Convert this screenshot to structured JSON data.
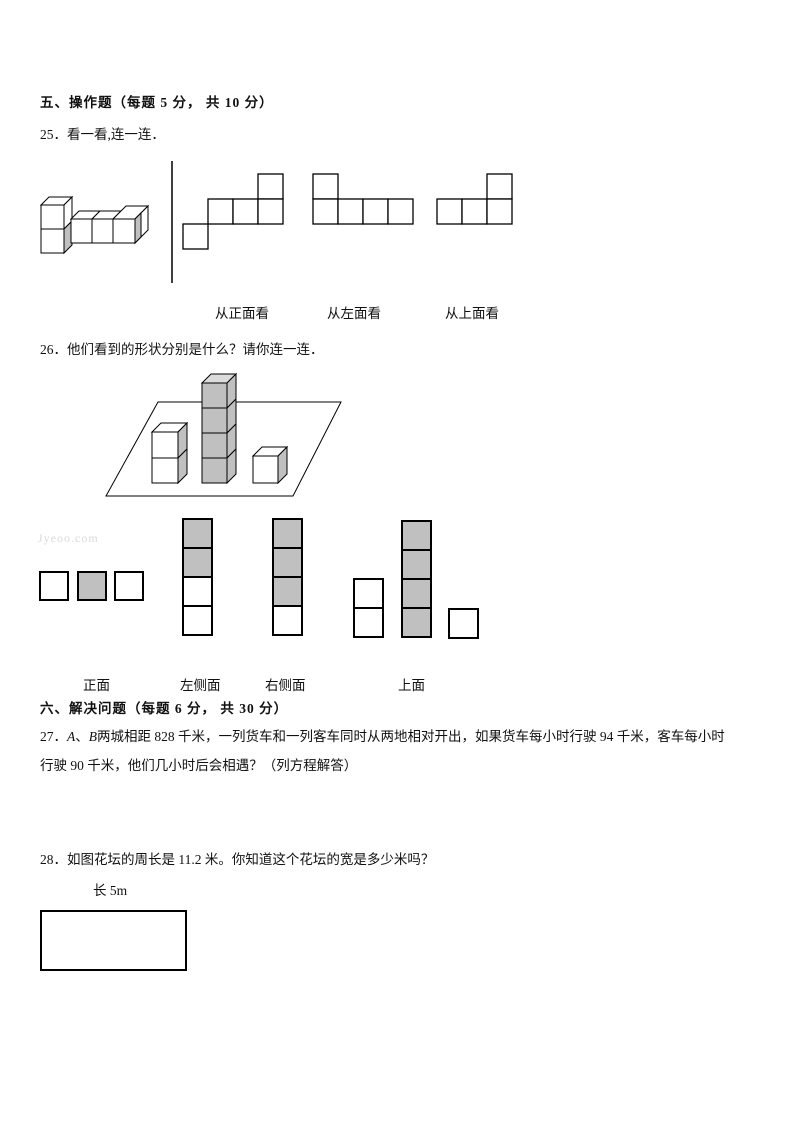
{
  "watermark": "Jyeoo.com",
  "colors": {
    "white": "#ffffff",
    "gray": "#c0c0c0",
    "light_gray": "#dcdcdc"
  },
  "section5": {
    "header": "五、操作题（每题 5 分， 共 10 分）",
    "q25": {
      "prompt": "25．看一看,连一连．",
      "view_labels": [
        {
          "text": "从正面看"
        },
        {
          "text": "从左面看"
        },
        {
          "text": "从上面看"
        }
      ],
      "nets": [
        {
          "origin_x": 183,
          "cell": 25,
          "squares": [
            [
              3,
              0
            ],
            [
              1,
              1
            ],
            [
              2,
              1
            ],
            [
              3,
              1
            ],
            [
              0,
              2
            ]
          ]
        },
        {
          "origin_x": 313,
          "cell": 25,
          "squares": [
            [
              0,
              0
            ],
            [
              0,
              1
            ],
            [
              1,
              1
            ],
            [
              2,
              1
            ],
            [
              3,
              1
            ]
          ]
        },
        {
          "origin_x": 437,
          "cell": 25,
          "squares": [
            [
              2,
              0
            ],
            [
              0,
              1
            ],
            [
              1,
              1
            ],
            [
              2,
              1
            ]
          ]
        }
      ]
    },
    "q26": {
      "prompt": "26．他们看到的形状分别是什么？请你连一连．",
      "answer_labels": [
        {
          "text": "正面"
        },
        {
          "text": "左侧面"
        },
        {
          "text": "右侧面"
        },
        {
          "text": "上面"
        }
      ],
      "answer_shapes": [
        {
          "name": "front-view",
          "cell": 28,
          "squares": [
            {
              "x": 40,
              "y": 572,
              "fill": "white"
            },
            {
              "x": 78,
              "y": 572,
              "fill": "gray"
            },
            {
              "x": 115,
              "y": 572,
              "fill": "white"
            }
          ]
        },
        {
          "name": "left-side-view",
          "cell": 29,
          "squares": [
            {
              "x": 183,
              "y": 519,
              "fill": "gray"
            },
            {
              "x": 183,
              "y": 548,
              "fill": "gray"
            },
            {
              "x": 183,
              "y": 577,
              "fill": "white"
            },
            {
              "x": 183,
              "y": 606,
              "fill": "white"
            }
          ]
        },
        {
          "name": "right-side-view",
          "cell": 29,
          "squares": [
            {
              "x": 273,
              "y": 519,
              "fill": "gray"
            },
            {
              "x": 273,
              "y": 548,
              "fill": "gray"
            },
            {
              "x": 273,
              "y": 577,
              "fill": "gray"
            },
            {
              "x": 273,
              "y": 606,
              "fill": "white"
            }
          ]
        },
        {
          "name": "top-view",
          "cell": 29,
          "squares": [
            {
              "x": 354,
              "y": 579,
              "fill": "white"
            },
            {
              "x": 354,
              "y": 608,
              "fill": "white"
            },
            {
              "x": 402,
              "y": 521,
              "fill": "gray"
            },
            {
              "x": 402,
              "y": 550,
              "fill": "gray"
            },
            {
              "x": 402,
              "y": 579,
              "fill": "gray"
            },
            {
              "x": 402,
              "y": 608,
              "fill": "gray"
            },
            {
              "x": 449,
              "y": 609,
              "fill": "white"
            }
          ]
        }
      ]
    }
  },
  "section6": {
    "header": "六、解决问题（每题 6 分， 共 30 分）",
    "q27": {
      "line1_segments": [
        {
          "text": "27．"
        },
        {
          "text": "A"
        },
        {
          "text": "、"
        },
        {
          "text": "B"
        },
        {
          "text": "两城相距 828 千米，一列货车和一列客车同时从两地相对开出，如果货车每小时行驶 94 千米，客车每小时"
        }
      ],
      "line2": "行驶 90 千米，他们几小时后会相遇？（列方程解答）"
    },
    "q28": {
      "prompt": "28．如图花坛的周长是 11.2 米。你知道这个花坛的宽是多少米吗？",
      "length_label": "长 5m"
    }
  },
  "figures": {
    "q25_solid": {
      "x": 38,
      "y": 193,
      "w": 125,
      "h": 70,
      "polys": [
        {
          "points": "3,12 11,4 34,4 26,12",
          "fill": "white"
        },
        {
          "points": "26,12 34,4 34,28 26,36",
          "fill": "white"
        },
        {
          "points": "26,36 34,28 34,52 26,60",
          "fill": "gray"
        },
        {
          "points": "3,12 26,12 26,36 3,36",
          "fill": "white"
        },
        {
          "points": "3,36 26,36 26,60 3,60",
          "fill": "white"
        },
        {
          "points": "33,26 41,18 62,18 54,26",
          "fill": "white"
        },
        {
          "points": "54,26 62,18 83,18 75,26",
          "fill": "white"
        },
        {
          "points": "75,26 88,13 110,13 97,26",
          "fill": "white"
        },
        {
          "points": "97,26 110,13 110,37 97,50",
          "fill": "white"
        },
        {
          "points": "97,26 103,20 103,44 97,50",
          "fill": "gray"
        },
        {
          "points": "33,26 54,26 54,50 33,50",
          "fill": "white"
        },
        {
          "points": "54,26 75,26 75,50 54,50",
          "fill": "white"
        },
        {
          "points": "75,26 97,26 97,50 75,50",
          "fill": "white"
        }
      ]
    },
    "q26_scene": {
      "x": 100,
      "y": 370,
      "w": 250,
      "h": 130,
      "polys": [
        {
          "points": "58,32 241,32 193,126 6,126",
          "fill": "white"
        },
        {
          "points": "52,62 61,53 87,53 78,62",
          "fill": "white"
        },
        {
          "points": "78,62 87,53 87,79 78,88",
          "fill": "gray"
        },
        {
          "points": "78,88 87,79 87,104 78,113",
          "fill": "gray"
        },
        {
          "points": "52,62 78,62 78,88 52,88",
          "fill": "white"
        },
        {
          "points": "52,88 78,88 78,113 52,113",
          "fill": "white"
        },
        {
          "points": "102,13 111,4 136,4 127,13",
          "fill": "light_gray"
        },
        {
          "points": "127,13 136,4 136,29 127,38",
          "fill": "gray"
        },
        {
          "points": "127,38 136,29 136,54 127,63",
          "fill": "gray"
        },
        {
          "points": "127,63 136,54 136,79 127,88",
          "fill": "gray"
        },
        {
          "points": "127,88 136,79 136,104 127,113",
          "fill": "gray"
        },
        {
          "points": "102,13 127,13 127,38 102,38",
          "fill": "gray"
        },
        {
          "points": "102,38 127,38 127,63 102,63",
          "fill": "gray"
        },
        {
          "points": "102,63 127,63 127,88 102,88",
          "fill": "gray"
        },
        {
          "points": "102,88 127,88 127,113 102,113",
          "fill": "gray"
        },
        {
          "points": "153,86 162,77 187,77 178,86",
          "fill": "white"
        },
        {
          "points": "178,86 187,77 187,104 178,113",
          "fill": "gray"
        },
        {
          "points": "153,86 178,86 178,113 153,113",
          "fill": "white"
        }
      ]
    }
  }
}
